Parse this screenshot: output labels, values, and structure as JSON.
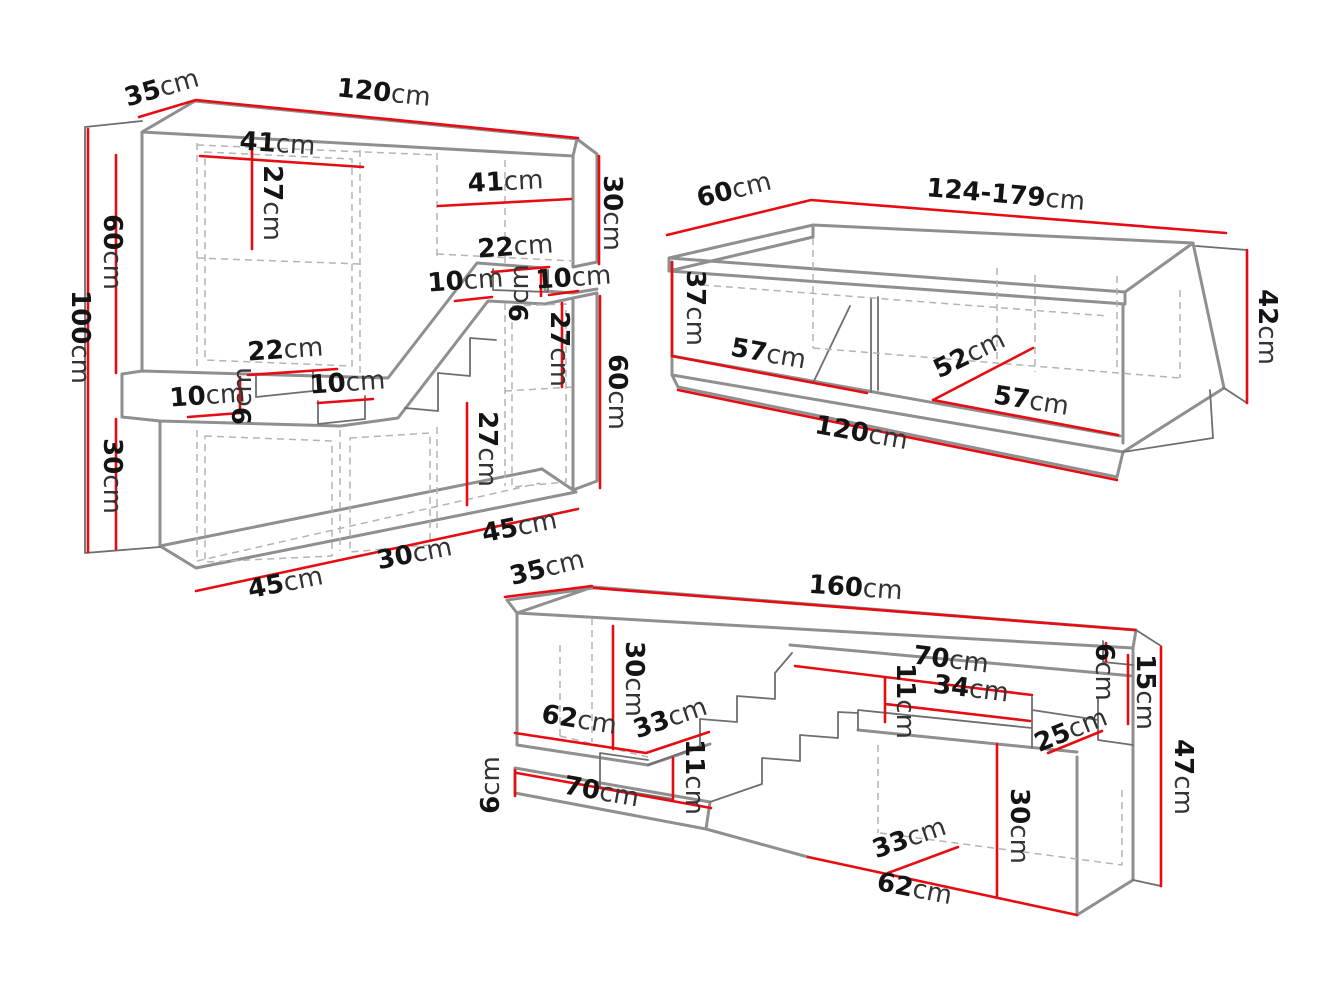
{
  "canvas": {
    "width": 1334,
    "height": 1000
  },
  "colors": {
    "background": "#ffffff",
    "dimension_red": "#e60c12",
    "outline_heavy": "#8f8f8f",
    "outline": "#6e6e6e",
    "hidden_edge": "#b4b4b4",
    "text": "#141414"
  },
  "pieces": [
    {
      "id": "wall-unit",
      "labels": [
        {
          "name": "depth-35",
          "text": "35cm",
          "x": 164,
          "y": 96,
          "r": -16
        },
        {
          "name": "width-120",
          "text": "120cm",
          "x": 383,
          "y": 101,
          "r": 6
        },
        {
          "name": "shelf-41-left",
          "text": "41cm",
          "x": 277,
          "y": 152,
          "r": 4
        },
        {
          "name": "shelf-27-left",
          "text": "27cm",
          "x": 264,
          "y": 203,
          "r": 90
        },
        {
          "name": "shelf-41-right",
          "text": "41cm",
          "x": 506,
          "y": 190,
          "r": -3
        },
        {
          "name": "height-30-right",
          "text": "30cm",
          "x": 604,
          "y": 213,
          "r": 90
        },
        {
          "name": "notch-22-right",
          "text": "22cm",
          "x": 516,
          "y": 255,
          "r": -4,
          "fs": 24
        },
        {
          "name": "notch-10-a",
          "text": "10cm",
          "x": 466,
          "y": 289,
          "r": -4,
          "fs": 24
        },
        {
          "name": "notch-9-right",
          "text": "9cm",
          "x": 528,
          "y": 293,
          "r": -90,
          "fs": 24
        },
        {
          "name": "notch-10-b",
          "text": "10cm",
          "x": 574,
          "y": 286,
          "r": -4,
          "fs": 24
        },
        {
          "name": "shelf-27-mid",
          "text": "27cm",
          "x": 551,
          "y": 349,
          "r": 90
        },
        {
          "name": "height-60-right",
          "text": "60cm",
          "x": 609,
          "y": 392,
          "r": 90
        },
        {
          "name": "height-100",
          "text": "100cm",
          "x": 72,
          "y": 337,
          "r": 90
        },
        {
          "name": "height-60-left",
          "text": "60cm",
          "x": 104,
          "y": 252,
          "r": 90
        },
        {
          "name": "notch-22-left",
          "text": "22cm",
          "x": 286,
          "y": 358,
          "r": -4,
          "fs": 24
        },
        {
          "name": "notch-9-left",
          "text": "9cm",
          "x": 251,
          "y": 396,
          "r": -90,
          "fs": 24
        },
        {
          "name": "notch-10-c",
          "text": "10cm",
          "x": 208,
          "y": 404,
          "r": -4,
          "fs": 24
        },
        {
          "name": "notch-10-d",
          "text": "10cm",
          "x": 348,
          "y": 391,
          "r": -4,
          "fs": 24
        },
        {
          "name": "shelf-27-bottom",
          "text": "27cm",
          "x": 479,
          "y": 449,
          "r": 90
        },
        {
          "name": "height-30-left",
          "text": "30cm",
          "x": 104,
          "y": 476,
          "r": 90
        },
        {
          "name": "width-45-left",
          "text": "45cm",
          "x": 287,
          "y": 591,
          "r": -11
        },
        {
          "name": "width-30-bottom",
          "text": "30cm",
          "x": 416,
          "y": 562,
          "r": -11
        },
        {
          "name": "width-45-right",
          "text": "45cm",
          "x": 521,
          "y": 535,
          "r": -11
        }
      ]
    },
    {
      "id": "coffee-table",
      "labels": [
        {
          "name": "depth-60",
          "text": "60cm",
          "x": 736,
          "y": 198,
          "r": -14
        },
        {
          "name": "width-124-179",
          "text": "124-179cm",
          "x": 1005,
          "y": 203,
          "r": 5
        },
        {
          "name": "inner-height-37",
          "text": "37cm",
          "x": 687,
          "y": 308,
          "r": 90
        },
        {
          "name": "inner-57-left",
          "text": "57cm",
          "x": 767,
          "y": 362,
          "r": 10
        },
        {
          "name": "inner-52",
          "text": "52cm",
          "x": 973,
          "y": 362,
          "r": -26
        },
        {
          "name": "inner-57-right",
          "text": "57cm",
          "x": 1030,
          "y": 409,
          "r": 9
        },
        {
          "name": "width-120",
          "text": "120cm",
          "x": 860,
          "y": 441,
          "r": 10
        },
        {
          "name": "height-42",
          "text": "42cm",
          "x": 1259,
          "y": 327,
          "r": 90
        }
      ]
    },
    {
      "id": "tv-stand",
      "labels": [
        {
          "name": "depth-35",
          "text": "35cm",
          "x": 549,
          "y": 576,
          "r": -14
        },
        {
          "name": "width-160",
          "text": "160cm",
          "x": 855,
          "y": 596,
          "r": 4
        },
        {
          "name": "inner-height-30",
          "text": "30cm",
          "x": 626,
          "y": 679,
          "r": 90
        },
        {
          "name": "shelf-70-right",
          "text": "70cm",
          "x": 950,
          "y": 668,
          "r": 7
        },
        {
          "name": "shelf-34",
          "text": "34cm",
          "x": 970,
          "y": 697,
          "r": 7
        },
        {
          "name": "slot-11-right",
          "text": "11cm",
          "x": 897,
          "y": 701,
          "r": 90
        },
        {
          "name": "lip-6-right",
          "text": "6cm",
          "x": 1096,
          "y": 672,
          "r": 90
        },
        {
          "name": "height-15",
          "text": "15cm",
          "x": 1137,
          "y": 692,
          "r": 90
        },
        {
          "name": "floor-62-left",
          "text": "62cm",
          "x": 578,
          "y": 728,
          "r": 9
        },
        {
          "name": "floor-33-left",
          "text": "33cm",
          "x": 673,
          "y": 726,
          "r": -19
        },
        {
          "name": "slot-11-left",
          "text": "11cm",
          "x": 686,
          "y": 777,
          "r": 90
        },
        {
          "name": "depth-25",
          "text": "25cm",
          "x": 1074,
          "y": 738,
          "r": -22
        },
        {
          "name": "height-47",
          "text": "47cm",
          "x": 1175,
          "y": 777,
          "r": 90
        },
        {
          "name": "strip-6-left",
          "text": "6cm",
          "x": 499,
          "y": 785,
          "r": -90
        },
        {
          "name": "strip-70-left",
          "text": "70cm",
          "x": 600,
          "y": 800,
          "r": 10
        },
        {
          "name": "door-30-right",
          "text": "30cm",
          "x": 1011,
          "y": 826,
          "r": 90
        },
        {
          "name": "floor-33-right",
          "text": "33cm",
          "x": 912,
          "y": 846,
          "r": -19
        },
        {
          "name": "width-62-bottom",
          "text": "62cm",
          "x": 913,
          "y": 897,
          "r": 11
        }
      ]
    }
  ]
}
